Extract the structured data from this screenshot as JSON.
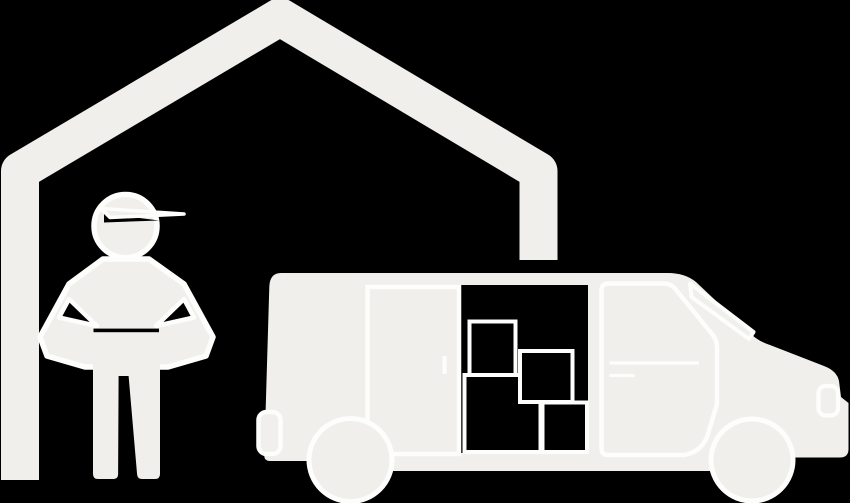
{
  "colors": {
    "background": "#000000",
    "fill": "#f0efec",
    "line": "#fdfdfc",
    "cutout": "#000000"
  },
  "illustration": {
    "parts": [
      {
        "name": "house-outline-icon"
      },
      {
        "name": "worker-figure-icon"
      },
      {
        "name": "moving-van-icon"
      },
      {
        "name": "cargo-box-icon",
        "count": 4
      }
    ]
  }
}
